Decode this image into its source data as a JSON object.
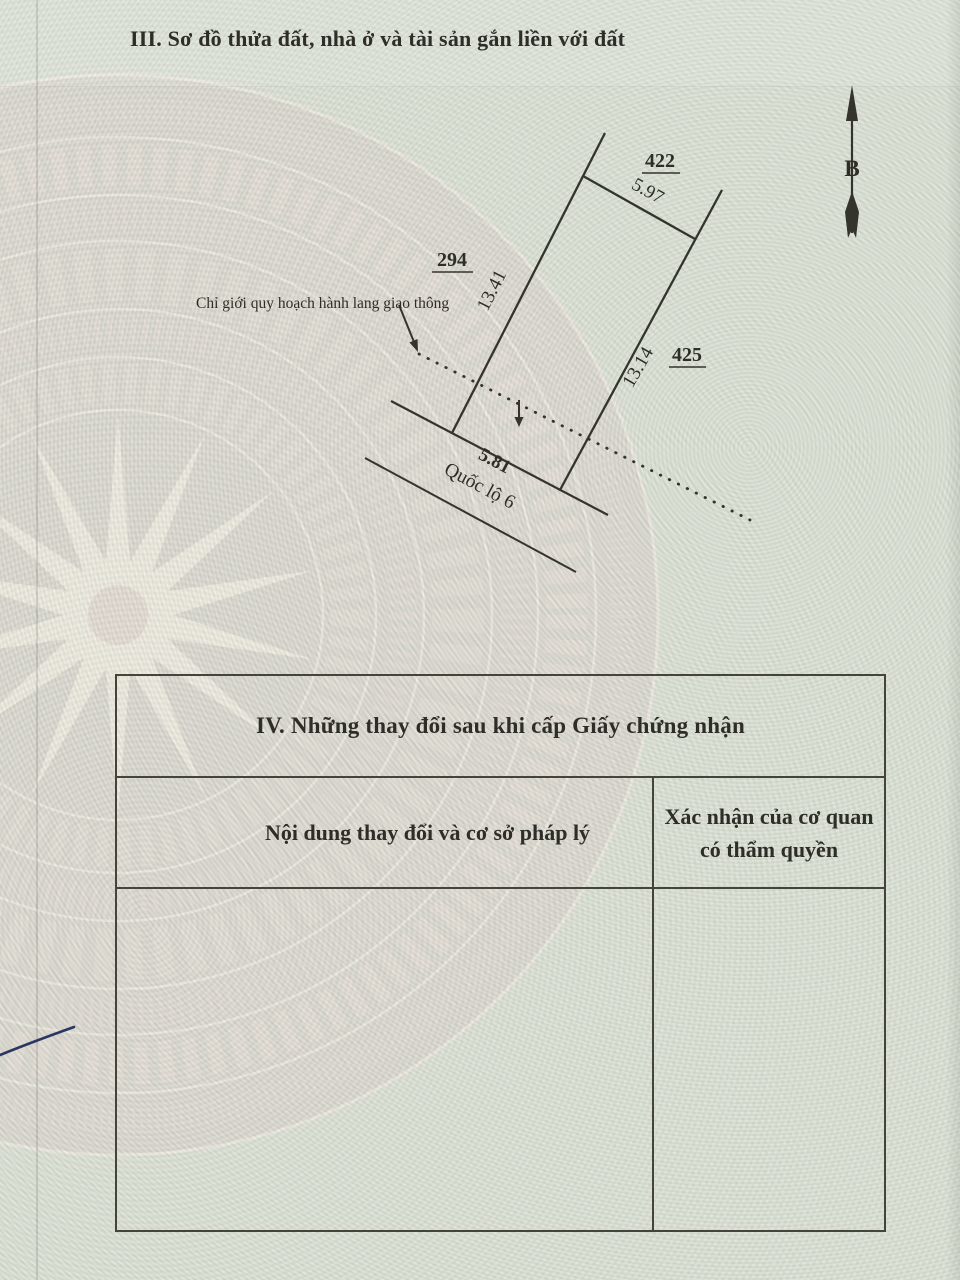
{
  "document": {
    "section_iii_title": "III. Sơ đồ thửa đất, nhà ở và tài sản gắn liền với đất",
    "section_iv": {
      "title": "IV. Những thay đổi sau khi cấp Giấy chứng nhận",
      "col_left_header": "Nội dung thay đổi và cơ sở pháp lý",
      "col_right_header_line1": "Xác nhận của cơ quan",
      "col_right_header_line2": "có thẩm quyền"
    }
  },
  "diagram": {
    "north_label": "B",
    "parcel_number_top": "422",
    "parcel_number_left": "294",
    "parcel_number_right": "425",
    "length_top_edge": "5.97",
    "length_left_edge": "13.41",
    "length_right_edge": "13.14",
    "length_bottom_edge": "5.81",
    "road_label": "Quốc lộ 6",
    "boundary_note": "Chỉ giới quy hoạch hành lang giao thông"
  },
  "colors": {
    "paper": "#dadfd3",
    "drum_pink": "#d5c5c2",
    "ink": "#2e2d27",
    "line": "#34332c",
    "pen_mark_blue": "#2c3663"
  }
}
